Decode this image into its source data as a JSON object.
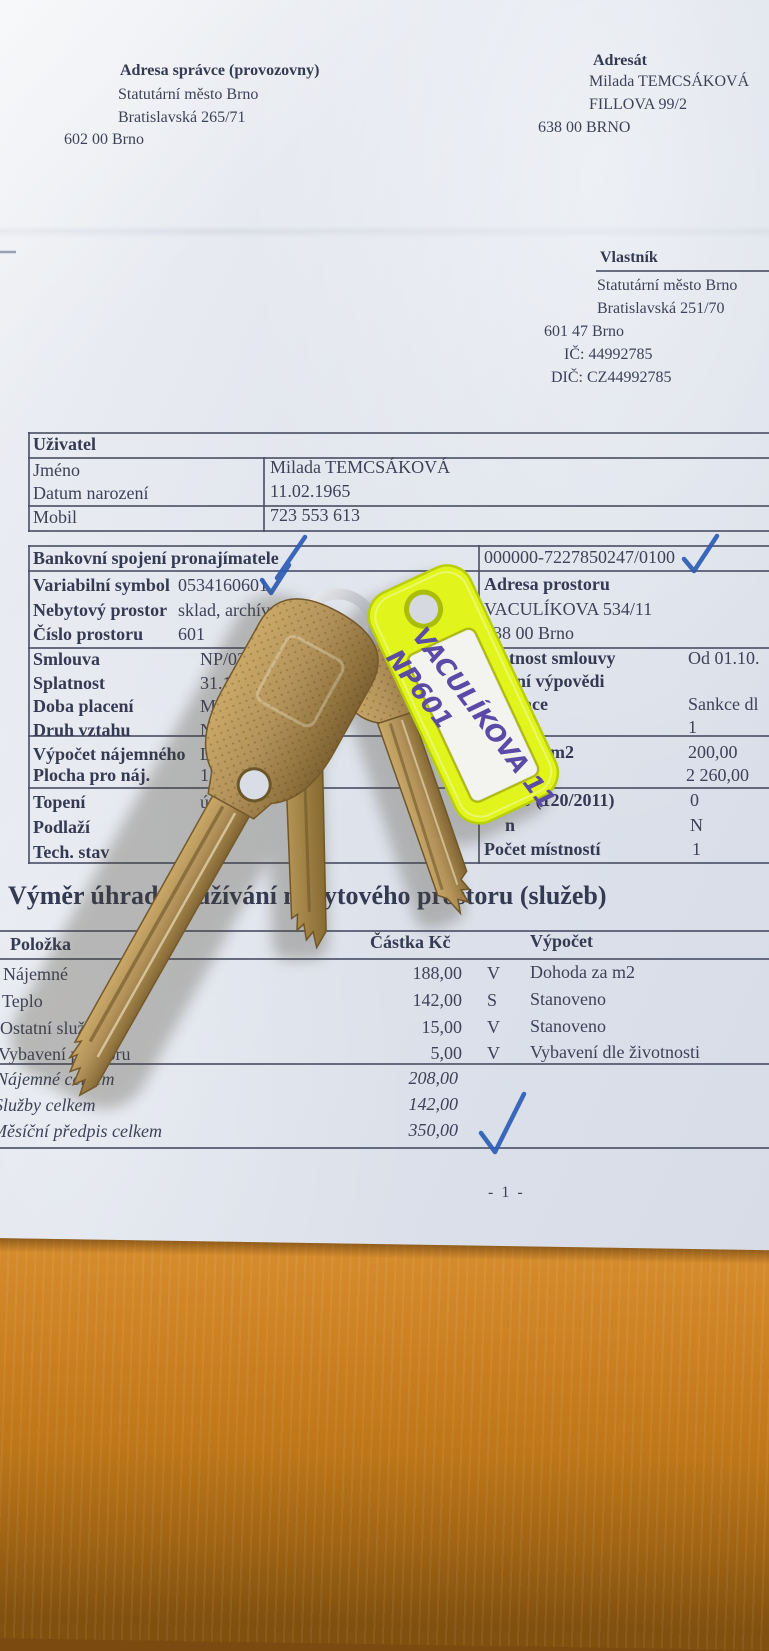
{
  "doc": {
    "admin": {
      "label": "Adresa správce (provozovny)",
      "org": "Statutární město Brno",
      "street": "Bratislavská 265/71",
      "zip_city": "602 00  Brno"
    },
    "addressee": {
      "label": "Adresát",
      "name": "Milada TEMCSÁKOVÁ",
      "street": "FILLOVA 99/2",
      "zip_city": "638 00  BRNO"
    },
    "owner": {
      "label": "Vlastník",
      "org": "Statutární město Brno",
      "street": "Bratislavská 251/70",
      "zip_city": "601 47  Brno",
      "ic": "IČ:  44992785",
      "dic": "DIČ:  CZ44992785"
    },
    "user": {
      "title": "Uživatel",
      "rows": [
        {
          "label": "Jméno",
          "value": "Milada TEMCSÁKOVÁ"
        },
        {
          "label": "Datum narození",
          "value": "11.02.1965"
        },
        {
          "label": "Mobil",
          "value": "723 553 613"
        }
      ]
    },
    "contract": {
      "left": [
        {
          "label": "Bankovní spojení pronajímatele",
          "value": ""
        },
        {
          "label": "Variabilní symbol",
          "value": "0534160601"
        },
        {
          "label": "Nebytový prostor",
          "value": "sklad, archív"
        },
        {
          "label": "Číslo prostoru",
          "value": "601"
        },
        {
          "label": "Smlouva",
          "value": "NP/027182/OB/20"
        },
        {
          "label": "Splatnost",
          "value": "31.10.20"
        },
        {
          "label": "Doba placení",
          "value": "Měsíč"
        },
        {
          "label": "Druh vztahu",
          "value": "Nájem"
        },
        {
          "label": "Výpočet nájemného",
          "value": "Dohod"
        },
        {
          "label": "Plocha pro náj.",
          "value": "11,30 m"
        },
        {
          "label": "Topení",
          "value": "ústřed"
        },
        {
          "label": "Podlaží",
          "value": "1"
        },
        {
          "label": "Tech. stav",
          "value": ""
        }
      ],
      "right": [
        {
          "label": "",
          "value": "000000-7227850247/0100"
        },
        {
          "label": "Adresa prostoru",
          "value": ""
        },
        {
          "label": "",
          "value": "VACULÍKOVA 534/11"
        },
        {
          "label": "",
          "value": "638 00 Brno"
        },
        {
          "label": "Platnost smlouvy",
          "value": "Od 01.10."
        },
        {
          "label": "dání výpovědi",
          "value": ""
        },
        {
          "label": "lizace",
          "value": "Sankce dl"
        },
        {
          "label": "sob",
          "value": "1"
        },
        {
          "label": "ba za m2",
          "value": "200,00"
        },
        {
          "label": "né",
          "value": "2 260,00"
        },
        {
          "label": "číslo (120/2011)",
          "value": "0"
        },
        {
          "label": "n",
          "value": "N"
        },
        {
          "label": "Počet místností",
          "value": "1"
        }
      ],
      "stray_fragment": "or,"
    },
    "fees": {
      "heading": "Výměr úhrad za užívání nebytového prostoru (služeb)",
      "columns": {
        "item": "Položka",
        "amount": "Částka Kč",
        "calc": "Výpočet"
      },
      "rows": [
        {
          "item": "Nájemné",
          "amount": "188,00",
          "flag": "V",
          "calc": "Dohoda za m2"
        },
        {
          "item": "Teplo",
          "amount": "142,00",
          "flag": "S",
          "calc": "Stanoveno"
        },
        {
          "item": "Ostatní služby 1",
          "amount": "15,00",
          "flag": "V",
          "calc": "Stanoveno"
        },
        {
          "item": "Vybavení prostoru",
          "amount": "5,00",
          "flag": "V",
          "calc": "Vybavení dle životnosti"
        }
      ],
      "totals": [
        {
          "item": "Nájemné celkem",
          "amount": "208,00"
        },
        {
          "item": "Služby celkem",
          "amount": "142,00"
        },
        {
          "item": "Měsíční předpis celkem",
          "amount": "350,00"
        }
      ]
    },
    "page_number": "- 1 -"
  },
  "tag": {
    "line1": "VACULÍKOVA 11",
    "line2": "NP601"
  },
  "colors": {
    "paper": "#dde2ea",
    "wood": "#c87d22",
    "ink_text": "#3d4257",
    "pen_blue": "#2d5cb5",
    "brass_key": "#b3975c",
    "tag_neon": "#e1f41c",
    "marker_purple": "#5b4aa6"
  }
}
